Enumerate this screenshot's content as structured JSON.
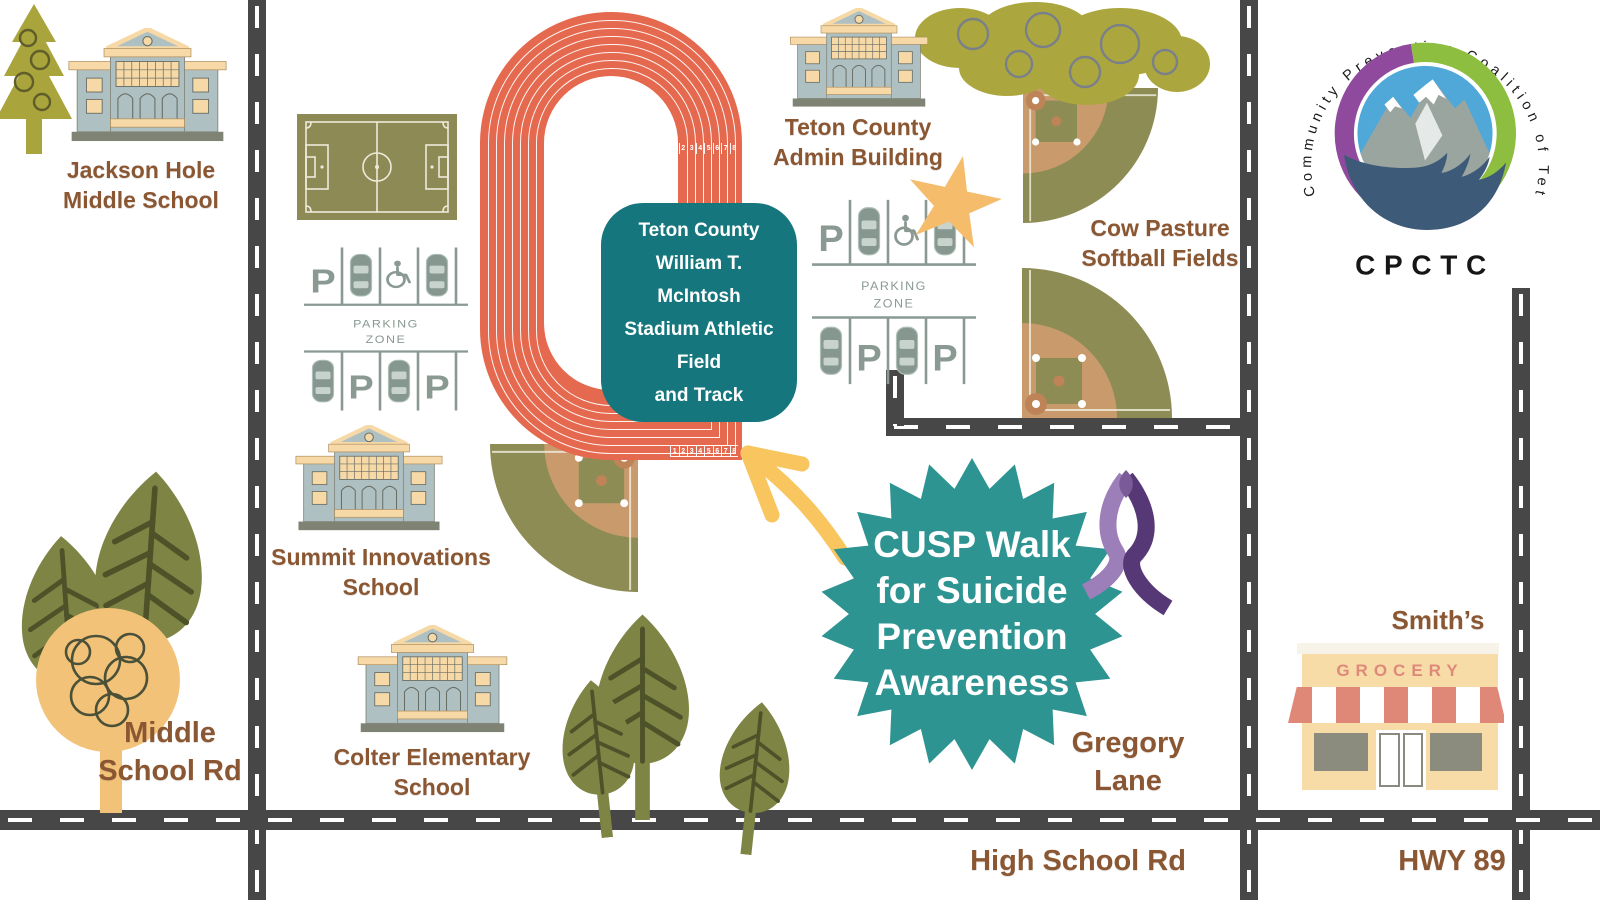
{
  "labels": {
    "jackson": {
      "l1": "Jackson Hole",
      "l2": "Middle School"
    },
    "admin": {
      "l1": "Teton County",
      "l2": "Admin Building"
    },
    "cow": {
      "l1": "Cow Pasture",
      "l2": "Softball Fields"
    },
    "summit": {
      "l1": "Summit Innovations",
      "l2": "School"
    },
    "colter": {
      "l1": "Colter Elementary",
      "l2": "School"
    },
    "smiths": {
      "name": "Smith’s",
      "sign": "GROCERY"
    }
  },
  "roads": {
    "middle": {
      "l1": "Middle",
      "l2": "School Rd"
    },
    "gregory": {
      "l1": "Gregory",
      "l2": "Lane"
    },
    "high": "High School Rd",
    "hwy": "HWY 89"
  },
  "stadium": {
    "l1": "Teton County",
    "l2": "William T.",
    "l3": "McIntosh",
    "l4": "Stadium Athletic",
    "l5": "Field",
    "l6": "and Track"
  },
  "badge": {
    "l1": "CUSP Walk",
    "l2": "for Suicide",
    "l3": "Prevention",
    "l4": "Awareness"
  },
  "parking": {
    "p": "P",
    "zone1": "PARKING",
    "zone2": "ZONE"
  },
  "track": {
    "lanes": [
      "1",
      "2",
      "3",
      "4",
      "5",
      "6",
      "7",
      "8"
    ]
  },
  "logo": {
    "ring_text": "Community Prevention Coalition of Teton County",
    "acronym": "CPCTC"
  },
  "palette": {
    "track_red": "#E5694E",
    "teal_box": "#15767E",
    "teal_burst": "#2E9492",
    "road_gray": "#474747",
    "label_brown": "#8B5732",
    "field_olive": "#8D8C55",
    "infield_tan": "#C89A6C",
    "building_blue_gray": "#AFC0C2",
    "cream": "#F6D9A6",
    "star_orange": "#F5BC6B",
    "arrow_yellow": "#F8C55F",
    "ribbon_light_purple": "#9C7EB8",
    "ribbon_dark_purple": "#573876",
    "logo_purple": "#8F4A9E",
    "logo_green": "#8EBE3F",
    "logo_blue": "#4FA8D8",
    "logo_hand_blue": "#3D5A78"
  }
}
